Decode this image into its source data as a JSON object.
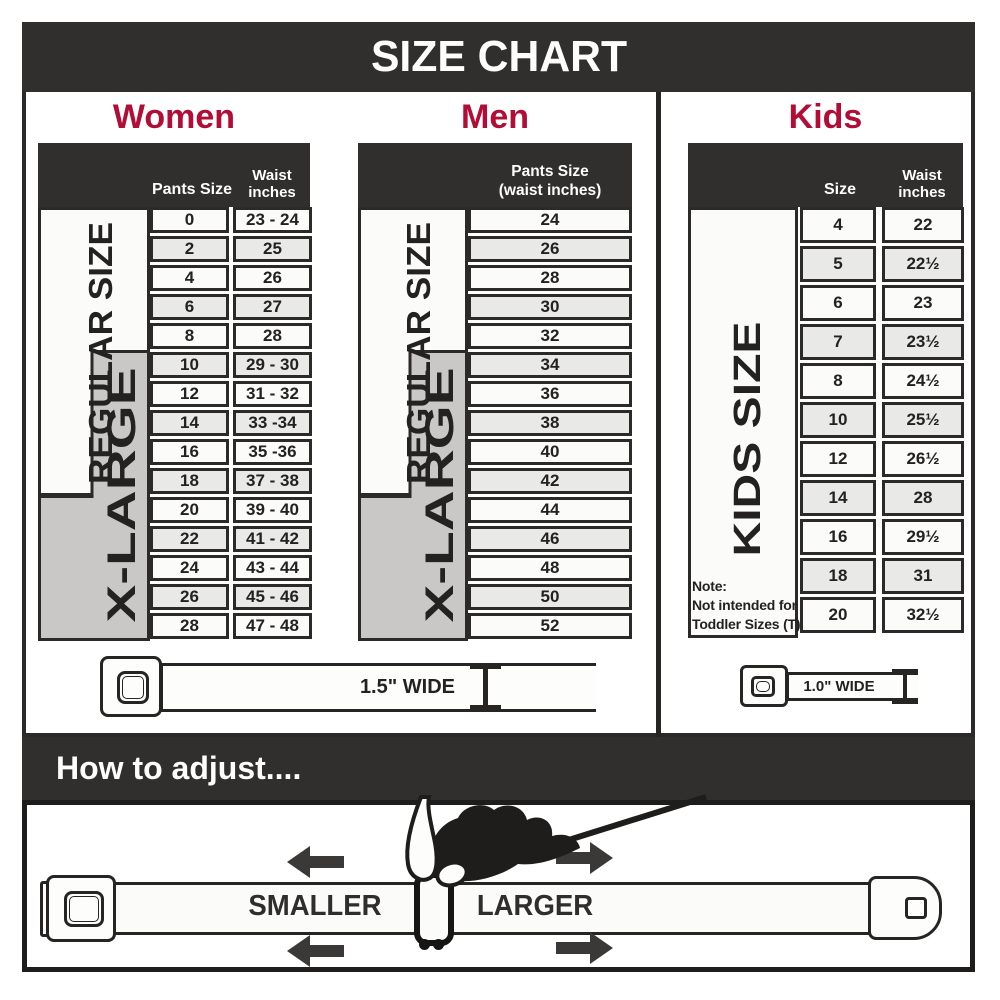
{
  "title": "SIZE CHART",
  "colors": {
    "bar_dark": "#312F2D",
    "accent_red": "#B10D36",
    "row_white": "#FBFBF9",
    "row_gray": "#E9E9E7",
    "xlarge_gray": "#C9C8C6",
    "border_dark": "#2B2A28"
  },
  "sections": {
    "women": {
      "title": "Women",
      "side_labels": {
        "regular": "REGULAR SIZE",
        "xlarge": "X-LARGE"
      },
      "header": {
        "col1": "Pants Size",
        "col2_line1": "Waist",
        "col2_line2": "inches"
      },
      "rows": [
        {
          "size": "0",
          "waist": "23 - 24"
        },
        {
          "size": "2",
          "waist": "25"
        },
        {
          "size": "4",
          "waist": "26"
        },
        {
          "size": "6",
          "waist": "27"
        },
        {
          "size": "8",
          "waist": "28"
        },
        {
          "size": "10",
          "waist": "29 - 30"
        },
        {
          "size": "12",
          "waist": "31 - 32"
        },
        {
          "size": "14",
          "waist": "33 -34"
        },
        {
          "size": "16",
          "waist": "35 -36"
        },
        {
          "size": "18",
          "waist": "37 - 38"
        },
        {
          "size": "20",
          "waist": "39 - 40"
        },
        {
          "size": "22",
          "waist": "41 - 42"
        },
        {
          "size": "24",
          "waist": "43 - 44"
        },
        {
          "size": "26",
          "waist": "45 - 46"
        },
        {
          "size": "28",
          "waist": "47 - 48"
        }
      ],
      "belt_width_label": "1.5\" WIDE"
    },
    "men": {
      "title": "Men",
      "side_labels": {
        "regular": "REGULAR SIZE",
        "xlarge": "X-LARGE"
      },
      "header_line1": "Pants Size",
      "header_line2": "(waist inches)",
      "rows": [
        "24",
        "26",
        "28",
        "30",
        "32",
        "34",
        "36",
        "38",
        "40",
        "42",
        "44",
        "46",
        "48",
        "50",
        "52"
      ]
    },
    "kids": {
      "title": "Kids",
      "side_label": "KIDS SIZE",
      "header": {
        "col1": "Size",
        "col2_line1": "Waist",
        "col2_line2": "inches"
      },
      "rows": [
        {
          "size": "4",
          "waist": "22"
        },
        {
          "size": "5",
          "waist": "22½"
        },
        {
          "size": "6",
          "waist": "23"
        },
        {
          "size": "7",
          "waist": "23½"
        },
        {
          "size": "8",
          "waist": "24½"
        },
        {
          "size": "10",
          "waist": "25½"
        },
        {
          "size": "12",
          "waist": "26½"
        },
        {
          "size": "14",
          "waist": "28"
        },
        {
          "size": "16",
          "waist": "29½"
        },
        {
          "size": "18",
          "waist": "31"
        },
        {
          "size": "20",
          "waist": "32½"
        }
      ],
      "note_line1": "Note:",
      "note_line2": "Not intended for",
      "note_line3": "Toddler Sizes (T)",
      "belt_width_label": "1.0\" WIDE"
    }
  },
  "how_to_adjust": {
    "title": "How to adjust....",
    "smaller_label": "SMALLER",
    "larger_label": "LARGER"
  }
}
